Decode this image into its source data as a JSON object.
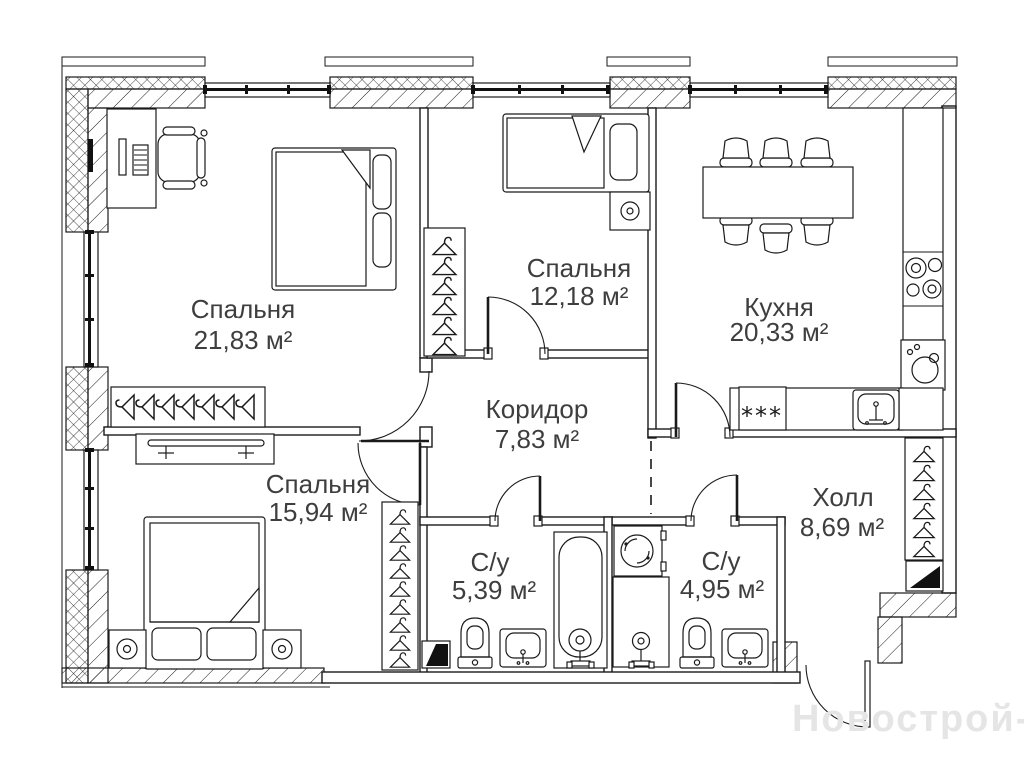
{
  "plan": {
    "watermark": "Новострой-М",
    "rooms": [
      {
        "name": "Спальня",
        "area": "21,83 м²"
      },
      {
        "name": "Спальня",
        "area": "12,18 м²"
      },
      {
        "name": "Кухня",
        "area": "20,33 м²"
      },
      {
        "name": "Коридор",
        "area": "7,83 м²"
      },
      {
        "name": "Спальня",
        "area": "15,94 м²"
      },
      {
        "name": "С/у",
        "area": "5,39 м²"
      },
      {
        "name": "С/у",
        "area": "4,95 м²"
      },
      {
        "name": "Холл",
        "area": "8,69 м²"
      }
    ],
    "symbols": {
      "fridge_marks": "***"
    },
    "colors": {
      "line": "#1a1a1a",
      "label": "#3e3e3e",
      "watermark": "#e5e5e5",
      "background": "#ffffff"
    }
  }
}
